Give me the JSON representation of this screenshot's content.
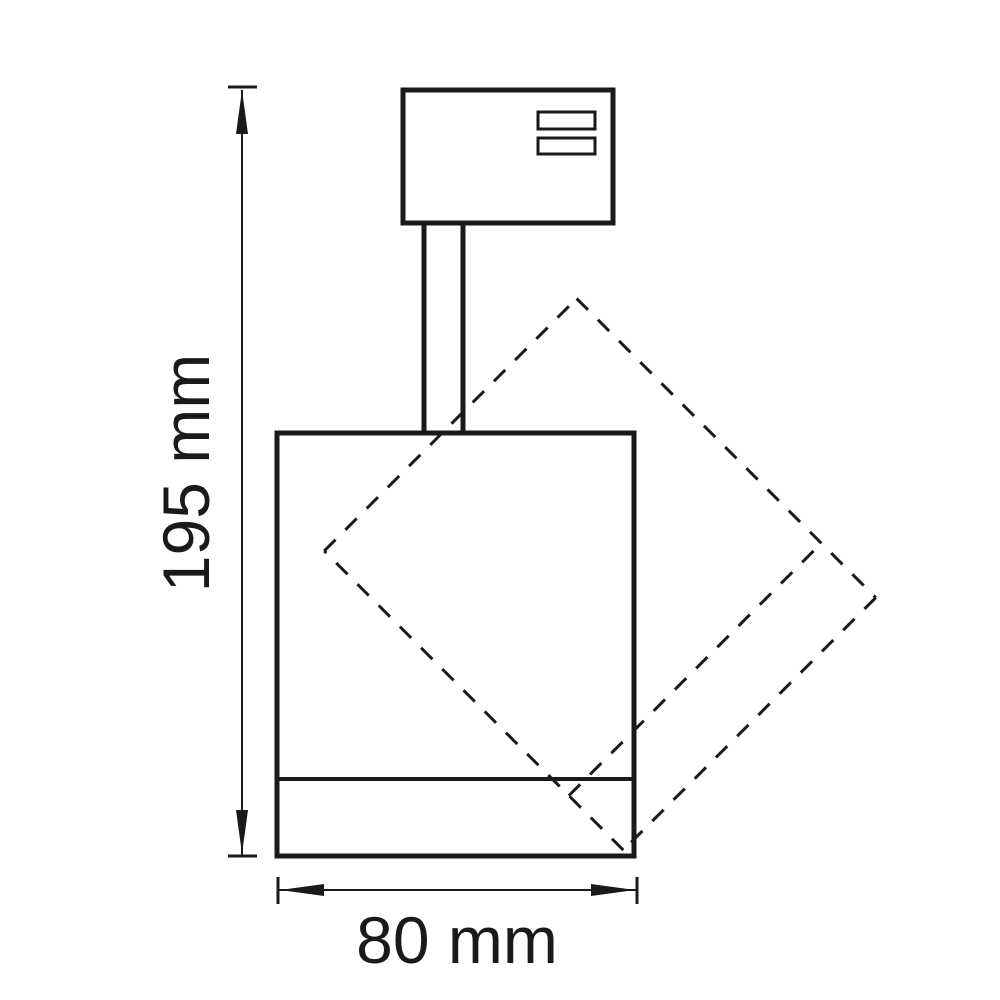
{
  "drawing": {
    "height_label": "195 mm",
    "width_label": "80 mm",
    "height_mm": 195,
    "width_mm": 80,
    "unit": "mm",
    "line_color": "#1a1a1a",
    "background_color": "#ffffff"
  }
}
